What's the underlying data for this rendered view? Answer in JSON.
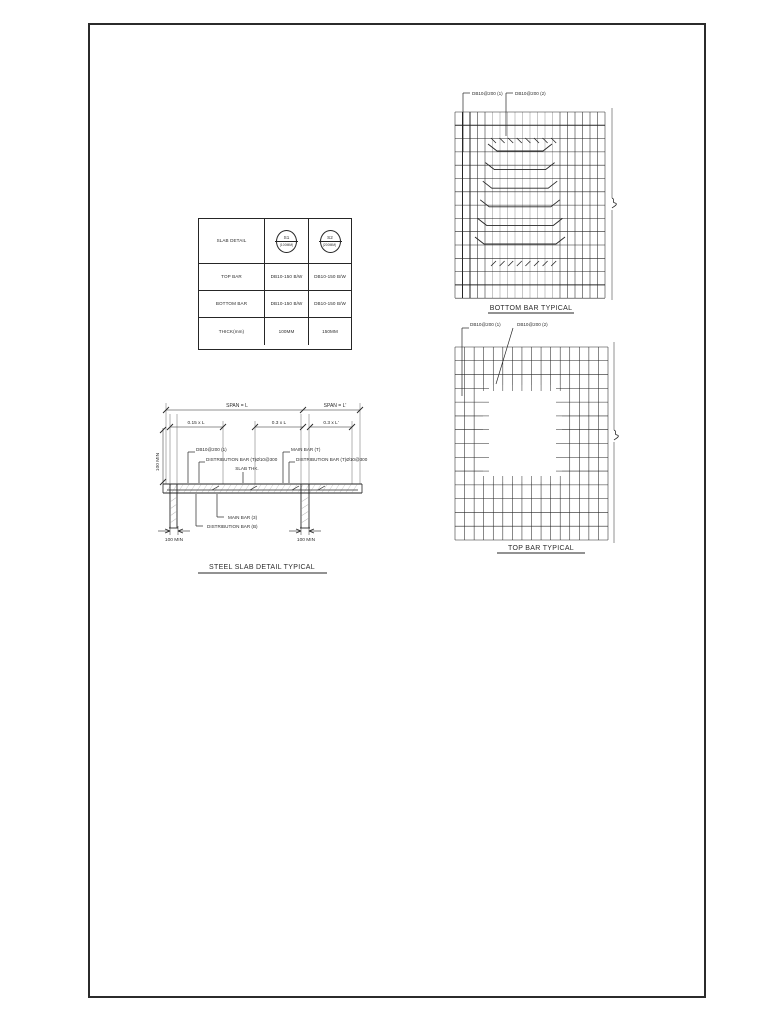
{
  "colors": {
    "ink": "#262626",
    "light_grid": "#9a9a9a",
    "hatch": "#b0b0b0"
  },
  "table": {
    "header_label": "SLAB DETAIL",
    "markers": [
      {
        "mark": "S1",
        "size": "(100MM)"
      },
      {
        "mark": "S2",
        "size": "(200MM)"
      }
    ],
    "rows": [
      {
        "label": "TOP BAR",
        "v1": "DB10-150 B/W",
        "v2": "DB10-150 B/W"
      },
      {
        "label": "BOTTOM BAR",
        "v1": "DB10-150 B/W",
        "v2": "DB10-150 B/W"
      },
      {
        "label": "THICK(mm)",
        "v1": "100MM",
        "v2": "150MM"
      }
    ]
  },
  "bottom_bar_diagram": {
    "title": "BOTTOM BAR TYPICAL",
    "callout_1": "DB10@200 (1)",
    "callout_2": "DB10@200 (2)"
  },
  "top_bar_diagram": {
    "title": "TOP BAR TYPICAL",
    "callout_1": "DB10@200 (1)",
    "callout_2": "DB10@200 (2)"
  },
  "section": {
    "title": "STEEL SLAB DETAIL TYPICAL",
    "span_left": "SPAN = L",
    "span_right": "SPAN = L'",
    "dim_015": "0.15 x L",
    "dim_03": "0.3 x L",
    "dim_03p": "0.3 x L'",
    "min_left_rotated": "100 MIN",
    "callout_top_bar": "DB10@200 (1)",
    "callout_dist_left": "DISTRIBUTION BAR (T)Ø10@300",
    "callout_slab_thk": "SLAB THK.",
    "callout_main_top": "MAIN BAR (T)",
    "callout_dist_right": "DISTRIBUTION BAR (T)Ø10@300",
    "callout_main_bottom": "MAIN BAR (3)",
    "callout_dist_bottom": "DISTRIBUTION BAR (B)",
    "min_support_left": "100 MIN",
    "min_support_right": "100 MIN"
  }
}
